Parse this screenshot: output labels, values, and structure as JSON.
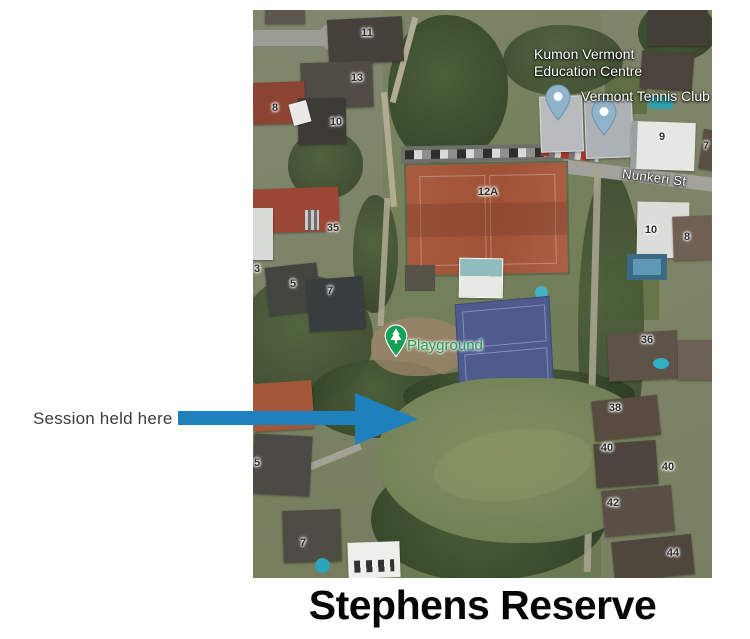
{
  "annotation": {
    "session_label": "Session held here",
    "arrow_color": "#1e80bc"
  },
  "caption": "Stephens Reserve",
  "map": {
    "kind": "satellite",
    "labels": {
      "kumon_line1": "Kumon Vermont",
      "kumon_line2": "Education Centre",
      "tennis_club": "Vermont Tennis Club",
      "street": "Nunkeri St",
      "playground": "Playground"
    },
    "markers": [
      {
        "name": "kumon-pin",
        "color": "#8fb3c9"
      },
      {
        "name": "tennis-club-pin",
        "color": "#8fb3c9"
      },
      {
        "name": "playground-pin",
        "color": "#12a256"
      }
    ],
    "colors": {
      "pin_blue": "#8fb3c9",
      "playground_green": "#12a256",
      "clay_court": "#a85a3e",
      "blue_court": "#4e5b8d"
    },
    "house_numbers": [
      {
        "label": "11",
        "x": 114,
        "y": 23
      },
      {
        "label": "13",
        "x": 104,
        "y": 68
      },
      {
        "label": "8",
        "x": 22,
        "y": 98
      },
      {
        "label": "10",
        "x": 83,
        "y": 112
      },
      {
        "label": "35",
        "x": 80,
        "y": 218
      },
      {
        "label": "3",
        "x": 4,
        "y": 259
      },
      {
        "label": "5",
        "x": 40,
        "y": 274
      },
      {
        "label": "7",
        "x": 77,
        "y": 281
      },
      {
        "label": "12A",
        "x": 235,
        "y": 182
      },
      {
        "label": "9",
        "x": 409,
        "y": 127
      },
      {
        "label": "7",
        "x": 453,
        "y": 136
      },
      {
        "label": "10",
        "x": 398,
        "y": 220
      },
      {
        "label": "8",
        "x": 434,
        "y": 227
      },
      {
        "label": "36",
        "x": 394,
        "y": 330
      },
      {
        "label": "38",
        "x": 362,
        "y": 398
      },
      {
        "label": "40",
        "x": 354,
        "y": 438
      },
      {
        "label": "40",
        "x": 415,
        "y": 457
      },
      {
        "label": "42",
        "x": 360,
        "y": 493
      },
      {
        "label": "44",
        "x": 420,
        "y": 543
      },
      {
        "label": "5",
        "x": 4,
        "y": 453
      },
      {
        "label": "7",
        "x": 50,
        "y": 533
      }
    ]
  }
}
